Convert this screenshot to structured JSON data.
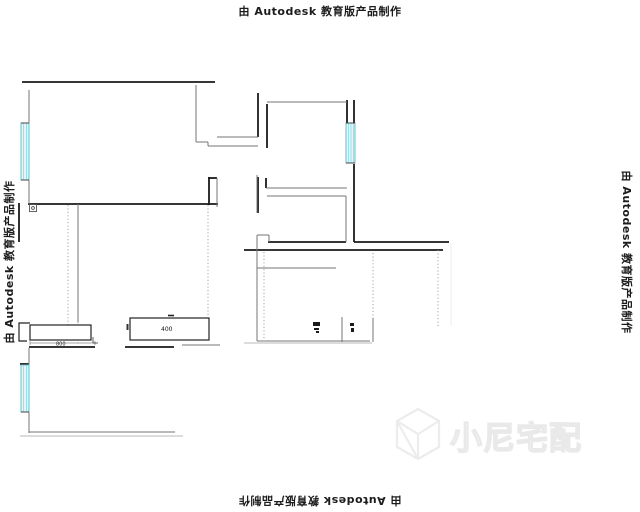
{
  "watermarks": {
    "autodesk_text": "由 Autodesk 教育版产品制作",
    "logo_text": "小尼宅配"
  },
  "plan": {
    "dim_label_left": "800",
    "dim_label_cabinet": "400"
  },
  "colors": {
    "wall": "#1a1a1a",
    "thin_wall": "#767676",
    "window_fill": "#e2f5f8",
    "window_stroke": "#5fc3cf",
    "logo_watermark": "#ececec"
  }
}
